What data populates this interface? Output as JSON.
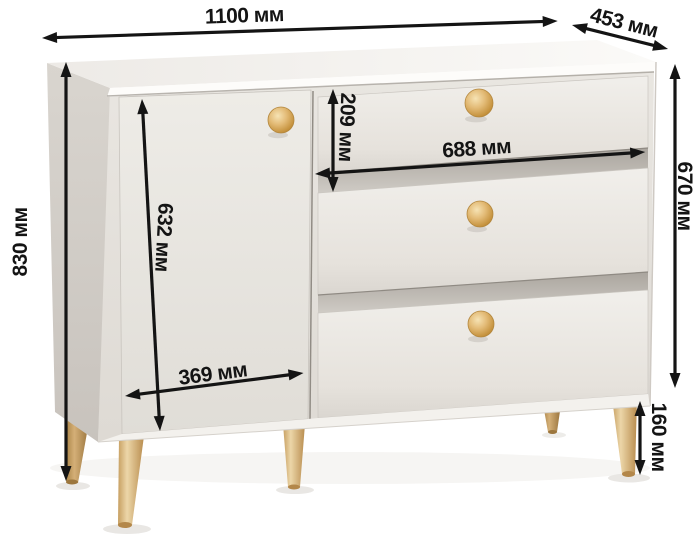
{
  "diagram": {
    "subject": "chest-of-drawers",
    "unit": "мм",
    "dimensions": {
      "overall_width": {
        "label": "1100 мм",
        "value": 1100
      },
      "depth": {
        "label": "453 мм",
        "value": 453
      },
      "overall_height": {
        "label": "830 мм",
        "value": 830
      },
      "body_height": {
        "label": "670 мм",
        "value": 670
      },
      "top_drawer_height": {
        "label": "209 мм",
        "value": 209
      },
      "drawer_width": {
        "label": "688 мм",
        "value": 688
      },
      "door_height": {
        "label": "632 мм",
        "value": 632
      },
      "door_width": {
        "label": "369 мм",
        "value": 369
      },
      "leg_height": {
        "label": "160 мм",
        "value": 160
      }
    },
    "colors": {
      "background": "#ffffff",
      "cabinet_body": "#e7e4df",
      "cabinet_top": "#f8f6f3",
      "cabinet_side": "#d7d3cd",
      "wood_legs": "#cfa869",
      "wood_knobs": "#ddb067",
      "annotation": "#141414"
    }
  }
}
